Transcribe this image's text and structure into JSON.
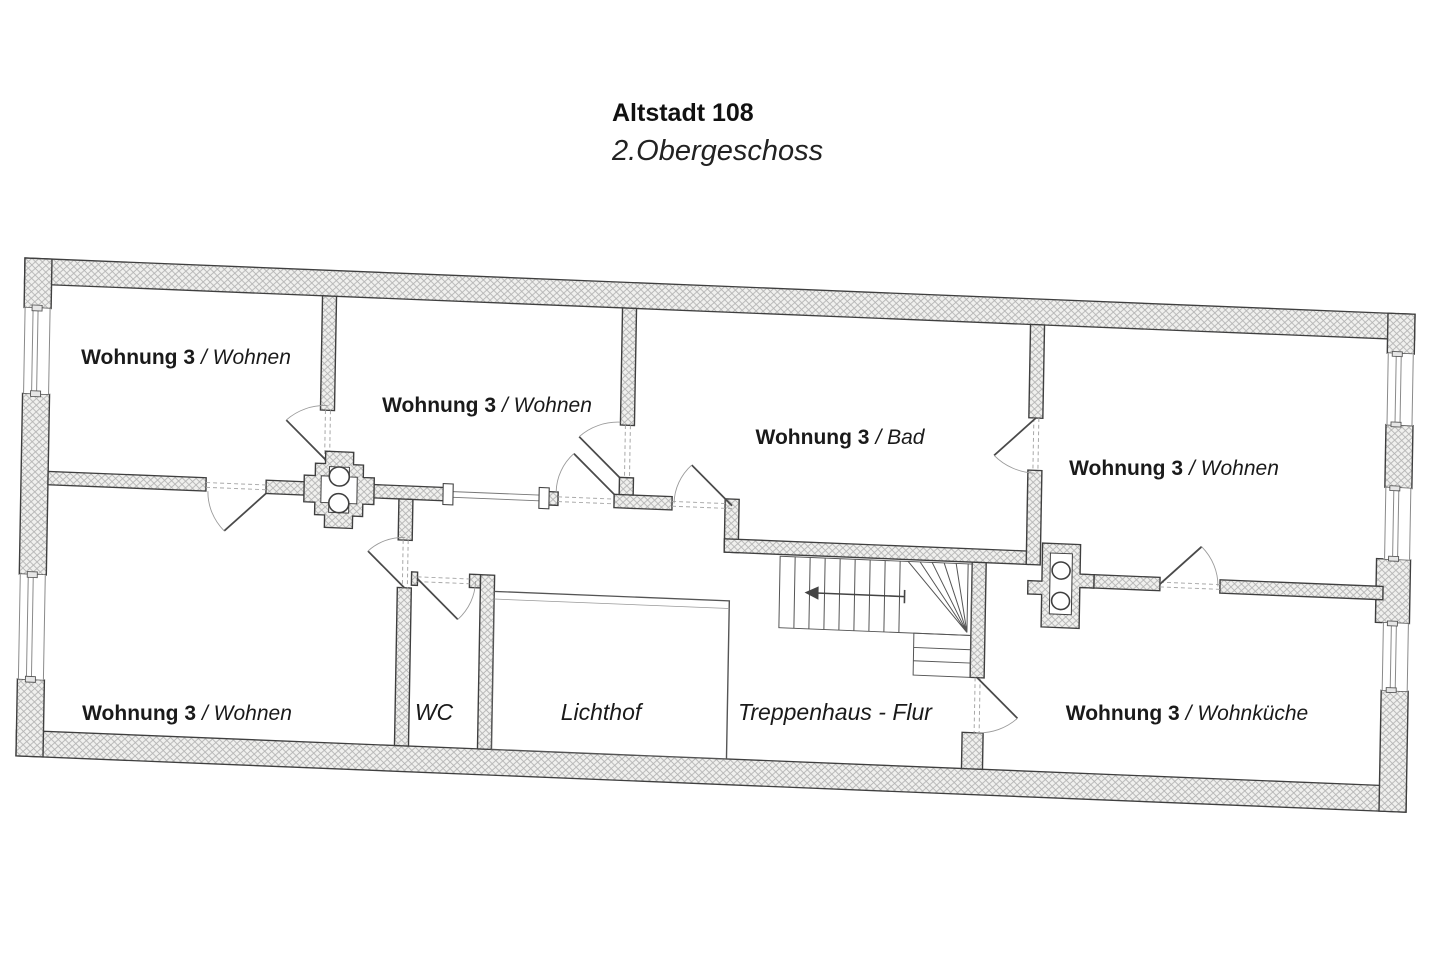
{
  "title": {
    "line1": "Altstadt 108",
    "line2": "2.Obergeschoss"
  },
  "rooms": [
    {
      "id": "wohnen-top-left",
      "label_bold": "Wohnung 3",
      "label_italic": "/ Wohnen"
    },
    {
      "id": "wohnen-top-middle",
      "label_bold": "Wohnung 3",
      "label_italic": "/ Wohnen"
    },
    {
      "id": "bad",
      "label_bold": "Wohnung 3",
      "label_italic": "/ Bad"
    },
    {
      "id": "wohnen-top-right",
      "label_bold": "Wohnung 3",
      "label_italic": "/ Wohnen"
    },
    {
      "id": "wohnen-bottom-left",
      "label_bold": "Wohnung 3",
      "label_italic": "/ Wohnen"
    },
    {
      "id": "wc",
      "label_bold": "",
      "label_italic": "WC"
    },
    {
      "id": "lichthof",
      "label_bold": "",
      "label_italic": "Lichthof"
    },
    {
      "id": "treppenhaus-flur",
      "label_bold": "",
      "label_italic": "Treppenhaus - Flur"
    },
    {
      "id": "wohnkueche",
      "label_bold": "Wohnung 3",
      "label_italic": "/ Wohnküche"
    }
  ],
  "icons": {
    "stairs_direction_icon": "left-arrow",
    "chimney_symbol": "cross-with-two-flue-circles"
  },
  "colors": {
    "background": "#ffffff",
    "wall_outline": "#3f3f3f",
    "wall_hatch_line": "#b3b3b3",
    "wall_fill": "#f0f0ee",
    "thin_line": "#666666",
    "dashed_opening": "#a8a8a8",
    "text": "#1a1a1a"
  }
}
